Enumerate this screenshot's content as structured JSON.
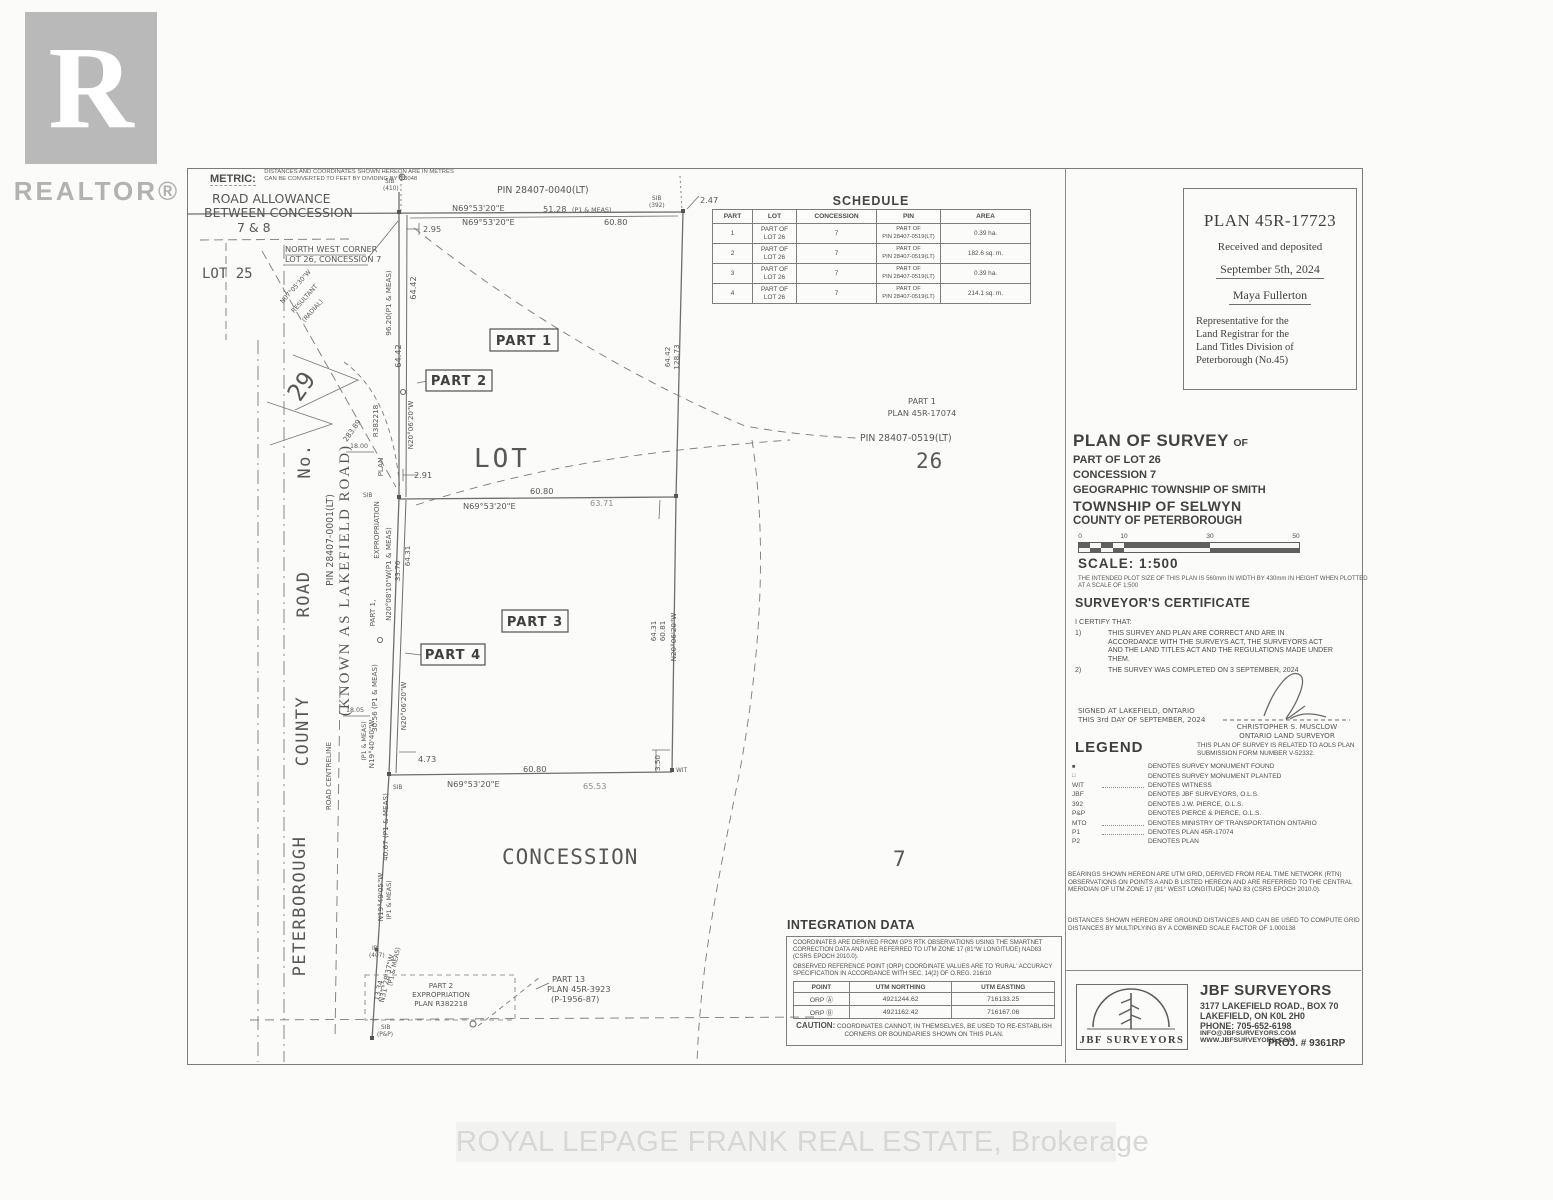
{
  "page": {
    "watermark": "ROYAL LEPAGE FRANK REAL ESTATE, Brokerage"
  },
  "realtor": {
    "letter": "R",
    "name": "REALTOR®"
  },
  "metric": {
    "label": "METRIC:",
    "note": "DISTANCES AND COORDINATES SHOWN HEREON ARE IN METRES CAN BE CONVERTED TO FEET BY DIVIDING BY 0.3048"
  },
  "schedule": {
    "title": "SCHEDULE",
    "headers": {
      "part": "PART",
      "lot": "LOT",
      "concession": "CONCESSION",
      "pin": "PIN",
      "area": "AREA"
    },
    "rows": [
      {
        "part": "1",
        "lot": "PART OF\nLOT 26",
        "concession": "7",
        "pin": "PART OF\nPIN 28407-0519(LT)",
        "area": "0.39 ha."
      },
      {
        "part": "2",
        "lot": "PART OF\nLOT 26",
        "concession": "7",
        "pin": "PART OF\nPIN 28407-0519(LT)",
        "area": "182.6 sq. m."
      },
      {
        "part": "3",
        "lot": "PART OF\nLOT 26",
        "concession": "7",
        "pin": "PART OF\nPIN 28407-0519(LT)",
        "area": "0.39 ha."
      },
      {
        "part": "4",
        "lot": "PART OF\nLOT 26",
        "concession": "7",
        "pin": "PART OF\nPIN 28407-0519(LT)",
        "area": "214.1 sq. m."
      }
    ]
  },
  "deposit": {
    "plan_no": "PLAN 45R-17723",
    "received": "Received and deposited",
    "date": "September 5th, 2024",
    "registrar": "Maya Fullerton",
    "rep": "Representative for the\nLand Registrar for the\nLand Titles Division of\nPeterborough  (No.45)"
  },
  "title_block": {
    "title": "PLAN OF SURVEY",
    "of": "OF",
    "line1": "PART OF LOT 26",
    "line2": "CONCESSION 7",
    "line3": "GEOGRAPHIC TOWNSHIP OF SMITH",
    "line4": "TOWNSHIP OF SELWYN",
    "line5": "COUNTY OF PETERBOROUGH",
    "scale_ticks": [
      "0",
      "10",
      "30",
      "50"
    ],
    "scale_label": "SCALE:  1:500",
    "plot_note": "THE INTENDED PLOT SIZE OF THIS PLAN IS 560mm IN WIDTH BY 430mm IN HEIGHT WHEN PLOTTED AT A SCALE OF 1:500"
  },
  "certificate": {
    "heading": "SURVEYOR'S CERTIFICATE",
    "intro": "I CERTIFY THAT:",
    "item1_no": "1)",
    "item1": "THIS SURVEY AND PLAN ARE CORRECT AND ARE IN ACCORDANCE WITH THE SURVEYS ACT, THE SURVEYORS ACT AND THE LAND TITLES ACT AND THE REGULATIONS MADE UNDER THEM.",
    "item2_no": "2)",
    "item2": "THE SURVEY WAS COMPLETED ON 3 SEPTEMBER, 2024",
    "signed1": "SIGNED AT LAKEFIELD, ONTARIO",
    "signed2": "THIS 3rd DAY OF SEPTEMBER, 2024",
    "surveyor": "CHRISTOPHER S. MUSCLOW",
    "surveyor_title": "ONTARIO LAND SURVEYOR",
    "aols": "THIS PLAN OF SURVEY IS RELATED TO AOLS PLAN SUBMISSION FORM NUMBER V-52332."
  },
  "legend": {
    "heading": "LEGEND",
    "items": [
      {
        "symbol": "■",
        "desc": "DENOTES SURVEY MONUMENT FOUND"
      },
      {
        "symbol": "□",
        "desc": "DENOTES SURVEY MONUMENT PLANTED"
      },
      {
        "symbol": "WIT",
        "desc": "DENOTES WITNESS"
      },
      {
        "symbol": "JBF",
        "desc": "DENOTES JBF SURVEYORS, O.L.S."
      },
      {
        "symbol": "392",
        "desc": "DENOTES J.W. PIERCE, O.L.S."
      },
      {
        "symbol": "P&P",
        "desc": "DENOTES PIERCE & PIERCE, O.L.S."
      },
      {
        "symbol": "MTO",
        "desc": "DENOTES MINISTRY OF TRANSPORTATION ONTARIO"
      },
      {
        "symbol": "P1",
        "desc": "DENOTES PLAN 45R-17074"
      },
      {
        "symbol": "P2",
        "desc": "DENOTES PLAN"
      }
    ]
  },
  "notes": {
    "bearings": "BEARINGS SHOWN HEREON ARE UTM GRID, DERIVED FROM REAL TIME NETWORK (RTN) OBSERVATIONS ON POINTS A AND B LISTED HEREON AND ARE REFERRED TO THE CENTRAL MERIDIAN OF UTM ZONE 17 (81° WEST LONGITUDE) NAD 83 (CSRS EPOCH 2010.0).",
    "distances": "DISTANCES SHOWN HEREON ARE GROUND DISTANCES AND CAN BE USED TO COMPUTE GRID DISTANCES BY MULTIPLYING BY A COMBINED SCALE FACTOR OF 1.000138"
  },
  "integration": {
    "heading": "INTEGRATION DATA",
    "note1": "COORDINATES ARE DERIVED FROM GPS RTK OBSERVATIONS USING THE SMARTNET CORRECTION DATA AND ARE REFERRED TO UTM ZONE 17 (81°W LONGITUDE) NAD83 (CSRS EPOCH 2010.0).",
    "note2": "OBSERVED REFERENCE POINT (ORP) COORDINATE VALUES ARE TO 'RURAL' ACCURACY SPECIFICATION IN ACCORDANCE WITH SEC. 14(2) OF O.REG. 216/10",
    "headers": {
      "point": "POINT",
      "northing": "UTM NORTHING",
      "easting": "UTM EASTING"
    },
    "rows": [
      {
        "point": "ORP Ⓐ",
        "northing": "4921244.62",
        "easting": "716133.25"
      },
      {
        "point": "ORP Ⓑ",
        "northing": "4921162.42",
        "easting": "716167.06"
      }
    ],
    "caution_label": "CAUTION:",
    "caution": "COORDINATES CANNOT, IN THEMSELVES, BE USED TO RE-ESTABLISH CORNERS OR BOUNDARIES SHOWN ON THIS PLAN."
  },
  "firm": {
    "logo_text": "JBF SURVEYORS",
    "name": "JBF SURVEYORS",
    "address1": "3177 LAKEFIELD ROAD., BOX 70",
    "address2": "LAKEFIELD, ON  K0L 2H0",
    "phone": "PHONE:  705-652-6198",
    "email": "INFO@JBFSURVEYORS.COM",
    "web": "WWW.JBFSURVEYORS.COM",
    "proj": "PROJ. # 9361RP"
  },
  "drawing": {
    "pin_top": "PIN 28407-0040(LT)",
    "pin_road": "PIN 28407-0001(LT)",
    "pin_0519": "PIN 28407-0519(LT)",
    "part1_ref_line1": "PART 1",
    "part1_ref_line2": "PLAN 45R-17074",
    "bearing_ne": "N69°53'20\"E",
    "d51_28": "51.28",
    "p1_meas": "(P1 & MEAS)",
    "d60_80": "60.80",
    "d2_95": "2.95",
    "d2_47": "2.47",
    "d2_91": "2.91",
    "d4_73": "4.73",
    "d3_50": "3.50",
    "d63_71": "63.71",
    "d65_53": "65.53",
    "d64_42": "64.42",
    "d128_73": "128.73",
    "d96_20": "96.20(P1 & MEAS)",
    "d33_76": "33.76",
    "d64_31": "64.31",
    "d60_81": "60.81",
    "d30_56": "30.56 (P1 & MEAS)",
    "d40_67": "40.67 (P1 & MEAS)",
    "d18_00": "18.00",
    "d18_05": "18.05",
    "d13_34": "13.34",
    "d283_89": "283.89",
    "b_n20_06": "N20°06'20\"W",
    "b_n20_08": "N20°08'10\"W(P1 & MEAS)",
    "b_n19_40": "N19°40'40\"W",
    "b_n19_49": "N19°49'05\"W",
    "b_n31_28": "N31°28'37\"W",
    "b_n07_05": "N07°05'30\"W",
    "resultant": "RESULTANT",
    "radial": "(RADIAL)",
    "part1": "PART 1",
    "part2": "PART 2",
    "part3": "PART 3",
    "part4": "PART 4",
    "part1_c": "PART 1,",
    "expropriation": "EXPROPRIATION",
    "plan_w": "PLAN",
    "r382218": "R382218",
    "lot": "LOT",
    "lot25": "LOT 25",
    "n26": "26",
    "n29": "29",
    "n7": "7",
    "concession": "CONCESSION",
    "road_allow1": "ROAD ALLOWANCE",
    "road_allow2": "BETWEEN CONCESSION",
    "road_allow3": "7 & 8",
    "nw1": "NORTH WEST CORNER",
    "nw2": "LOT 26, CONCESSION 7",
    "peterborough": "PETERBOROUGH",
    "county": "COUNTY",
    "road": "ROAD",
    "no": "No.",
    "known_as": "(KNOWN AS LAKEFIELD ROAD)",
    "road_centreline": "ROAD CENTRELINE",
    "p2x1": "PART 2",
    "p2x2": "EXPROPRIATION",
    "p2x3": "PLAN R382218",
    "p13x1": "PART 13",
    "p13x2": "PLAN 45R-3923",
    "p13x3": "(P-1956-87)",
    "sib": "SIB",
    "s392": "(392)",
    "s410": "(410)",
    "ib": "IB",
    "s407": "(407)",
    "spp": "(P&P)",
    "wit": "WIT"
  }
}
